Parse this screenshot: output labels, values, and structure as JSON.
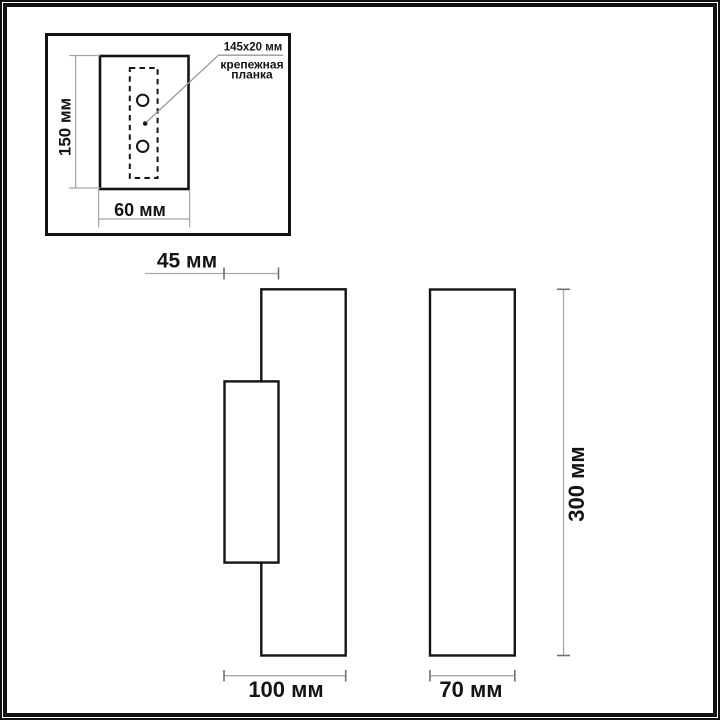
{
  "diagram": {
    "inset": {
      "bracket_size_label": "145x20 мм",
      "bracket_caption_line1": "крепежная",
      "bracket_caption_line2": "планка",
      "plate_height_label": "150 мм",
      "plate_width_label": "60 мм"
    },
    "side_view": {
      "top_depth_label": "45 мм",
      "total_depth_label": "100 мм"
    },
    "front_view": {
      "width_label": "70 мм",
      "height_label": "300 мм"
    },
    "colors": {
      "outline": "#141414",
      "dimension_line": "#a8a8a8",
      "dimension_tick": "#6f6f6f",
      "background": "#ffffff"
    },
    "units": "мм"
  }
}
